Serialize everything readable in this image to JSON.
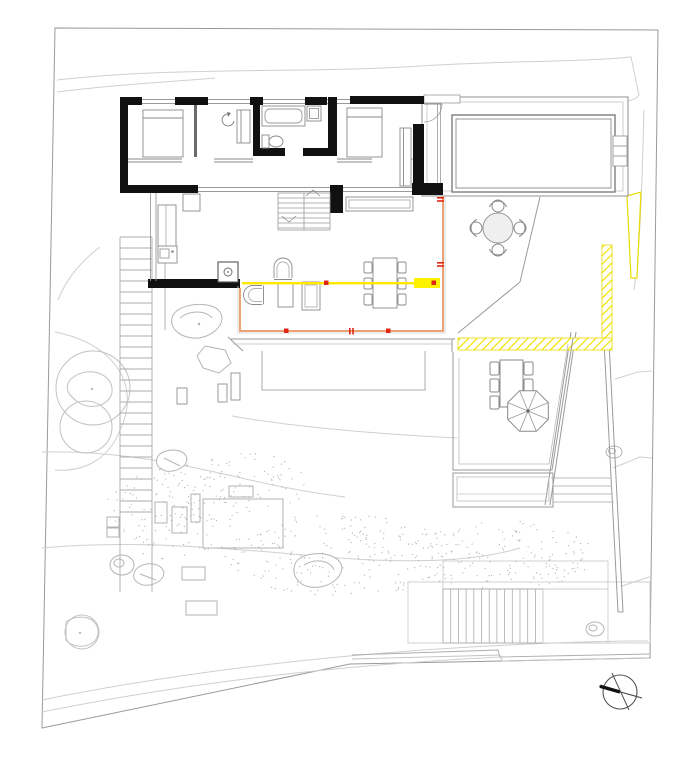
{
  "document": {
    "kind": "architectural site and floor plan drawing (no visible text)",
    "background": "#ffffff"
  },
  "colors": {
    "walls": "#111111",
    "furniture_lines": "#8a8a8a",
    "site_lines": "#aaaaaa",
    "contour_lines": "#cfcfcf",
    "glass_facade_highlight": "#eda275",
    "section_line_yellow": "#ffe800",
    "highlight_block_yellow": "#fff200",
    "hatch_yellow": "#efe300",
    "marker_red": "#e02616"
  },
  "plan_elements": {
    "building": [
      "bedroom wing with two bedrooms and bathroom (beds, bathtub, sink, toilet, wardrobe)",
      "living wing with kitchen, interior stair, sideboard, dining table with six chairs, sofa group",
      "entry door with swing arc",
      "orange highlighted glass facade with red markers",
      "yellow section line with red markers"
    ],
    "outdoor": [
      "swimming pool with side steps on pool deck",
      "round table with four chairs",
      "terrace with rectangular table, chairs and parasol",
      "planter box",
      "yellow hatched retaining walls",
      "long west garden stair",
      "south garden stair with landing",
      "gravel band, trees, rocks, small garden structures",
      "site boundary and contour lines",
      "north arrow"
    ]
  }
}
